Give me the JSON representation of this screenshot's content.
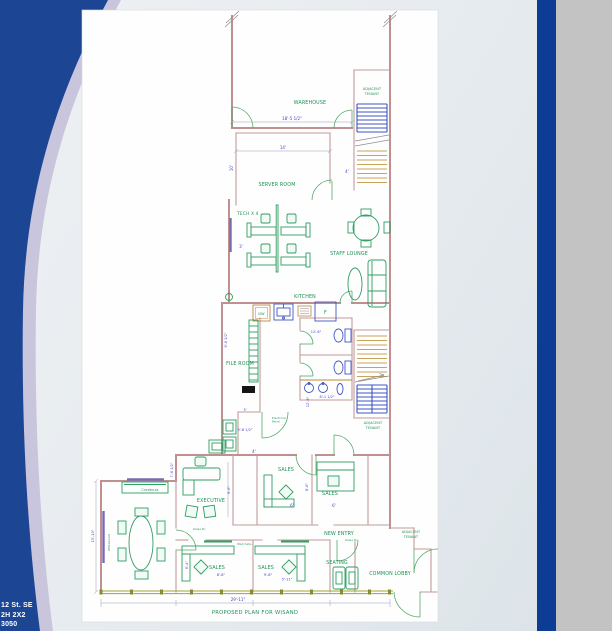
{
  "slide": {
    "corner_lines": [
      "12 St. SE",
      "2H 2X2",
      "3050"
    ],
    "colors": {
      "accent_navy": "#1c4693",
      "accent_bar": "#0d3c95",
      "stripe": "#c9c5dd",
      "slide_background": "#e7ebee",
      "desktop_gray": "#c3c3c3",
      "plan_wall": "#c08f8f",
      "plan_green": "#1e9155",
      "plan_dim_blue": "#4743c0"
    }
  },
  "plan": {
    "title": "PROPOSED PLAN FOR WISAND",
    "labels": {
      "warehouse": "WAREHOUSE",
      "server_room": "SERVER ROOM",
      "tech": "TECH X 4",
      "staff_lounge": "STAFF LOUNGE",
      "kitchen": "KITCHEN",
      "file_room": "FILE ROOM",
      "adjacent1": "ADJACENT",
      "adjacent2": "TENANT",
      "executive": "EXECUTIVE",
      "sales": "SALES",
      "new_entry": "NEW ENTRY",
      "seating": "SEATING",
      "common_lobby": "COMMON LOBBY",
      "credenza": "Credenza",
      "wall_cabs": "Wall Cabs.",
      "whiteboard": "Whiteboard",
      "glass_door": "Glass Dr.",
      "elec1": "Electrical",
      "elec2": "Panel",
      "dw": "DW",
      "fridge": "F"
    },
    "dims": {
      "d18_5": "18'-5 1/2\"",
      "d14": "14'",
      "d10": "10'",
      "d4": "4'",
      "d3": "3'",
      "d12_6": "12'-6\"",
      "d6_6": "6'-6 1/2\"",
      "d8_1": "8'-1 1/2\"",
      "d12_9": "12'-9\"",
      "d9_6h": "9'-6 1/2\"",
      "d7_6": "7'-6 1/2\"",
      "d9_6": "9'-6\"",
      "d15_10": "15'-10\"",
      "d6": "6'",
      "d8_6": "8'-6\"",
      "d6_4": "6'-4\"",
      "d8_8": "8'-8\"",
      "d9_8": "9'-8\"",
      "d5_11": "5'-11\"",
      "d29_11": "29'-11\""
    }
  }
}
